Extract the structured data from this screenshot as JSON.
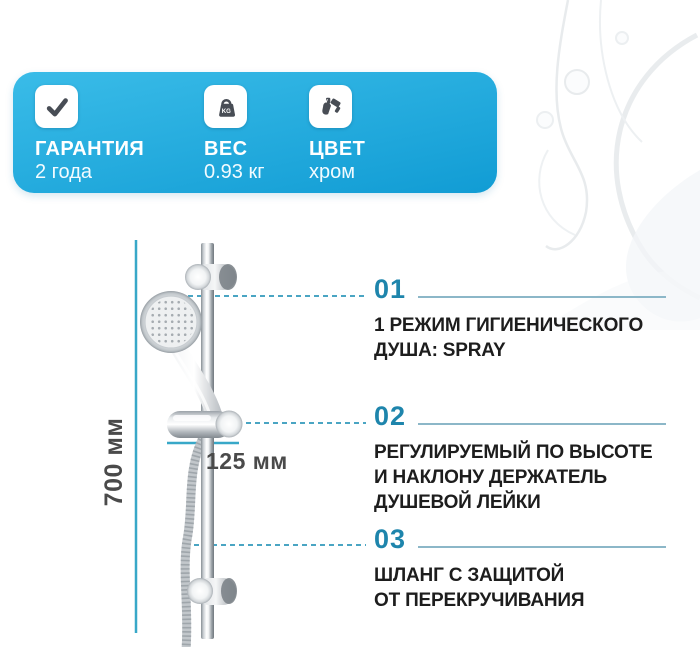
{
  "banner": {
    "items": [
      {
        "id": "warranty",
        "icon": "check-icon",
        "label": "ГАРАНТИЯ",
        "value": "2 года"
      },
      {
        "id": "weight",
        "icon": "weight-icon",
        "label": "ВЕС",
        "value": "0.93 кг",
        "icon_text": "KG"
      },
      {
        "id": "color",
        "icon": "paint-brush-icon",
        "label": "ЦВЕТ",
        "value": "хром"
      }
    ]
  },
  "dimensions": {
    "height": "700 мм",
    "width": "125 мм"
  },
  "features": [
    {
      "number": "01",
      "text": "1 РЕЖИМ ГИГИЕНИЧЕСКОГО\nДУША: SPRAY"
    },
    {
      "number": "02",
      "text": "РЕГУЛИРУЕМЫЙ ПО ВЫСОТЕ\nИ НАКЛОНУ ДЕРЖАТЕЛЬ\nДУШЕВОЙ ЛЕЙКИ"
    },
    {
      "number": "03",
      "text": "ШЛАНГ С ЗАЩИТОЙ\nОТ ПЕРЕКРУЧИВАНИЯ"
    }
  ],
  "colors": {
    "banner_top": "#3abce8",
    "banner_bottom": "#119cd4",
    "accent": "#1e85ac",
    "rule": "#8cb7c8",
    "leader": "#4aa5c3",
    "dimension": "#38a8c8",
    "text_dark": "#1d1d1d",
    "dim_text": "#4a4a4a",
    "icon": "#484d55"
  }
}
